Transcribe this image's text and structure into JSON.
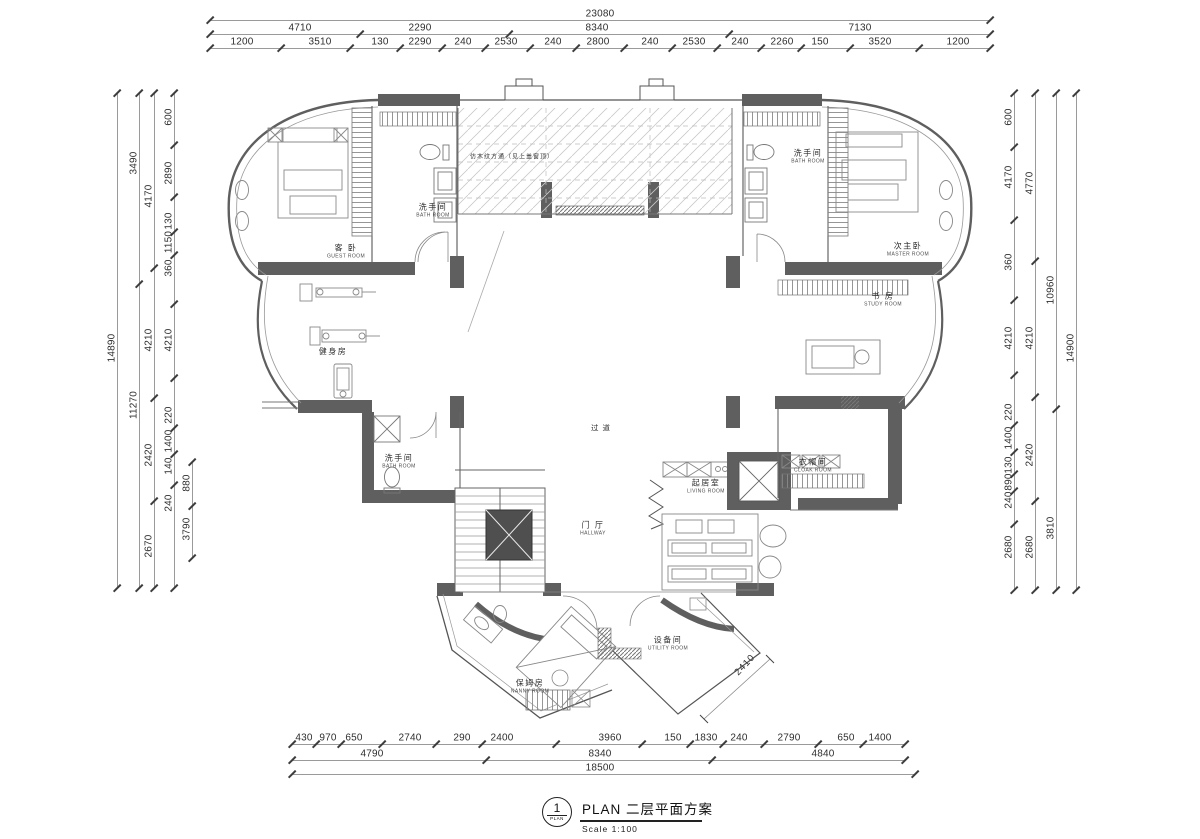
{
  "title_block": {
    "index": "1",
    "index_caption": "PLAN",
    "title": "PLAN  二层平面方案",
    "scale": "Scale 1:100"
  },
  "annotations": [
    {
      "text": "仿木纹方通（见上盖窗顶）",
      "x": 470,
      "y": 156,
      "size": 6,
      "rot": 0,
      "anchor": "left"
    },
    {
      "text": "过 道",
      "x": 601,
      "y": 428,
      "size": 7.5,
      "rot": 0,
      "anchor": "center"
    },
    {
      "text": "2410",
      "x": 745,
      "y": 665,
      "size": 9.5,
      "rot": -47,
      "anchor": "center"
    }
  ],
  "rooms": [
    {
      "cn": "客 卧",
      "en": "GUEST ROOM",
      "x": 346,
      "y": 252
    },
    {
      "cn": "洗手间",
      "en": "BATH ROOM",
      "x": 433,
      "y": 211
    },
    {
      "cn": "健身房",
      "en": "",
      "x": 333,
      "y": 352
    },
    {
      "cn": "洗手间",
      "en": "BATH ROOM",
      "x": 399,
      "y": 462
    },
    {
      "cn": "次主卧",
      "en": "MASTER ROOM",
      "x": 908,
      "y": 250
    },
    {
      "cn": "洗手间",
      "en": "BATH ROOM",
      "x": 808,
      "y": 157
    },
    {
      "cn": "书 房",
      "en": "STUDY ROOM",
      "x": 883,
      "y": 300
    },
    {
      "cn": "衣帽间",
      "en": "CLOAK ROOM",
      "x": 813,
      "y": 466
    },
    {
      "cn": "起居室",
      "en": "LIVING ROOM",
      "x": 706,
      "y": 487
    },
    {
      "cn": "门 厅",
      "en": "HALLWAY",
      "x": 593,
      "y": 529
    },
    {
      "cn": "保姆房",
      "en": "NANNY ROOM",
      "x": 530,
      "y": 687
    },
    {
      "cn": "设备间",
      "en": "UTILITY ROOM",
      "x": 668,
      "y": 644
    }
  ],
  "dims": {
    "h_rows": [
      {
        "y": 14,
        "x1": 210,
        "x2": 990,
        "items": [
          {
            "t": "23080",
            "x": 600
          }
        ]
      },
      {
        "y": 28,
        "x1": 210,
        "x2": 990,
        "items": [
          {
            "t": "4710",
            "x": 300
          },
          {
            "t": "2290",
            "x": 420
          },
          {
            "t": "8340",
            "x": 597
          },
          {
            "t": "7130",
            "x": 860
          }
        ]
      },
      {
        "y": 42,
        "x1": 210,
        "x2": 990,
        "items": [
          {
            "t": "1200",
            "x": 242
          },
          {
            "t": "3510",
            "x": 320
          },
          {
            "t": "130",
            "x": 380
          },
          {
            "t": "2290",
            "x": 420
          },
          {
            "t": "240",
            "x": 463
          },
          {
            "t": "2530",
            "x": 506
          },
          {
            "t": "240",
            "x": 553
          },
          {
            "t": "2800",
            "x": 598
          },
          {
            "t": "240",
            "x": 650
          },
          {
            "t": "2530",
            "x": 694
          },
          {
            "t": "240",
            "x": 740
          },
          {
            "t": "2260",
            "x": 782
          },
          {
            "t": "150",
            "x": 820
          },
          {
            "t": "3520",
            "x": 880
          },
          {
            "t": "1200",
            "x": 958
          }
        ]
      },
      {
        "y": 738,
        "x1": 292,
        "x2": 905,
        "items": [
          {
            "t": "430",
            "x": 304
          },
          {
            "t": "970",
            "x": 328
          },
          {
            "t": "650",
            "x": 354
          },
          {
            "t": "2740",
            "x": 410
          },
          {
            "t": "290",
            "x": 462
          },
          {
            "t": "2400",
            "x": 502
          },
          {
            "t": "3960",
            "x": 610
          },
          {
            "t": "150",
            "x": 673
          },
          {
            "t": "1830",
            "x": 706
          },
          {
            "t": "240",
            "x": 739
          },
          {
            "t": "2790",
            "x": 789
          },
          {
            "t": "650",
            "x": 846
          },
          {
            "t": "1400",
            "x": 880
          }
        ]
      },
      {
        "y": 754,
        "x1": 292,
        "x2": 905,
        "items": [
          {
            "t": "4790",
            "x": 372
          },
          {
            "t": "8340",
            "x": 600
          },
          {
            "t": "4840",
            "x": 823
          }
        ]
      },
      {
        "y": 768,
        "x1": 292,
        "x2": 915,
        "items": [
          {
            "t": "18500",
            "x": 600
          }
        ]
      }
    ],
    "v_cols": [
      {
        "x": 112,
        "y1": 93,
        "y2": 588,
        "items": [
          {
            "t": "14890",
            "y": 348
          }
        ]
      },
      {
        "x": 134,
        "y1": 93,
        "y2": 588,
        "items": [
          {
            "t": "3490",
            "y": 163
          },
          {
            "t": "11270",
            "y": 405
          }
        ]
      },
      {
        "x": 149,
        "y1": 93,
        "y2": 588,
        "items": [
          {
            "t": "4170",
            "y": 196
          },
          {
            "t": "4210",
            "y": 340
          },
          {
            "t": "2420",
            "y": 455
          },
          {
            "t": "2670",
            "y": 546
          }
        ]
      },
      {
        "x": 169,
        "y1": 93,
        "y2": 588,
        "items": [
          {
            "t": "600",
            "y": 117
          },
          {
            "t": "2890",
            "y": 173
          },
          {
            "t": "130",
            "y": 221
          },
          {
            "t": "1150",
            "y": 242
          },
          {
            "t": "360",
            "y": 268
          },
          {
            "t": "4210",
            "y": 340
          },
          {
            "t": "220",
            "y": 415
          },
          {
            "t": "1400",
            "y": 441
          },
          {
            "t": "140",
            "y": 466
          },
          {
            "t": "240",
            "y": 503
          }
        ]
      },
      {
        "x": 187,
        "y1": 462,
        "y2": 558,
        "items": [
          {
            "t": "880",
            "y": 483
          },
          {
            "t": "3790",
            "y": 529
          }
        ]
      },
      {
        "x": 1009,
        "y1": 93,
        "y2": 590,
        "items": [
          {
            "t": "600",
            "y": 117
          },
          {
            "t": "4170",
            "y": 177
          },
          {
            "t": "360",
            "y": 262
          },
          {
            "t": "4210",
            "y": 338
          },
          {
            "t": "220",
            "y": 412
          },
          {
            "t": "1400",
            "y": 438
          },
          {
            "t": "130",
            "y": 465
          },
          {
            "t": "890",
            "y": 482
          },
          {
            "t": "240",
            "y": 500
          },
          {
            "t": "2680",
            "y": 547
          }
        ]
      },
      {
        "x": 1030,
        "y1": 93,
        "y2": 590,
        "items": [
          {
            "t": "4770",
            "y": 183
          },
          {
            "t": "4210",
            "y": 338
          },
          {
            "t": "2420",
            "y": 455
          },
          {
            "t": "2680",
            "y": 547
          }
        ]
      },
      {
        "x": 1051,
        "y1": 93,
        "y2": 590,
        "items": [
          {
            "t": "10960",
            "y": 290
          },
          {
            "t": "3810",
            "y": 528
          }
        ]
      },
      {
        "x": 1071,
        "y1": 93,
        "y2": 590,
        "items": [
          {
            "t": "14900",
            "y": 348
          }
        ]
      }
    ]
  }
}
